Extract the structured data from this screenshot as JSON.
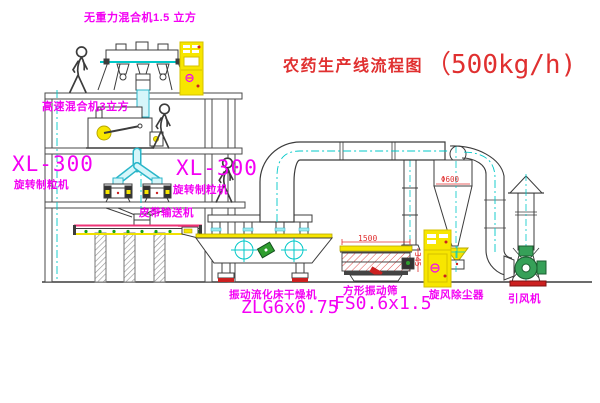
{
  "title": {
    "zh": "农药生产线流程图",
    "capacity": "（500kg/h)"
  },
  "labels": {
    "mixer_top": "无重力混合机1.5 立方",
    "mixer_high_speed": "高速混合机3立方",
    "granulator_left_model": "XL-300",
    "granulator_left_name": "旋转制粒机",
    "granulator_right_model": "XL-300",
    "granulator_right_name": "旋转制粒机",
    "belt_conveyor": "皮带输送机",
    "dryer_name": "振动流化床干燥机",
    "dryer_model": "ZLG6x0.75",
    "screen_name": "方形振动筛",
    "screen_model": "FS0.6x1.5",
    "cyclone": "旋风除尘器",
    "fan": "引风机"
  },
  "dimensions": {
    "screen_length": "1500",
    "screen_height": "345",
    "cyclone_diameter": "Φ600"
  },
  "colors": {
    "label_magenta": "#f400f4",
    "title_red": "#e03030",
    "machine_yellow": "#f7e600",
    "centerline_cyan": "#00c8c8",
    "motor_green": "#2f9e2f",
    "fan_green": "#36a058",
    "dimension_red": "#e03030",
    "base_red": "#cc2020",
    "line_dark": "#3c3c3c"
  }
}
